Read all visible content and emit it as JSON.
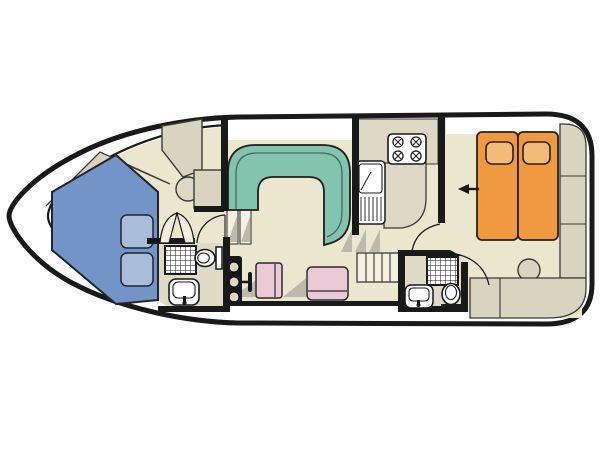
{
  "diagram": {
    "type": "boat-deck-plan",
    "orientation": {
      "bow": "left",
      "stern": "right"
    },
    "colors": {
      "hull": "#191919",
      "floor": "#ebe7cf",
      "bathroomFloor": "#dfdbc6",
      "cabinet": "#d8d4c0",
      "counter": "#dcd8c4",
      "sofa": "#82c4ae",
      "vberth": "#7394c7",
      "vberthPillow": "#a9bddb",
      "bedOrange": "#ef9940",
      "bedPillow": "#f4ba77",
      "seatPink": "#ecc9d7",
      "shadow": "#bdbaab",
      "fixture": "#ffffff",
      "steps": "#f4f1e0",
      "doorLeaf": "#f2eedd",
      "console": "#17181c"
    },
    "rooms": [
      {
        "id": "forward-cabin",
        "label": "forward-cabin-v-berth"
      },
      {
        "id": "forward-bathroom",
        "label": "forward-bathroom"
      },
      {
        "id": "saloon",
        "label": "saloon-with-u-sofa-and-helm"
      },
      {
        "id": "galley",
        "label": "galley"
      },
      {
        "id": "aft-bathroom",
        "label": "aft-bathroom"
      },
      {
        "id": "aft-cabin",
        "label": "aft-cabin-double-bed"
      }
    ],
    "furniture": [
      "v-berth-bed",
      "v-berth-pillows",
      "wardrobe",
      "cabinet",
      "wash-basin",
      "shower",
      "toilet",
      "sink",
      "helm-console",
      "throttle-lever",
      "helm-seat",
      "bench-seat",
      "u-sofa",
      "stove-4-burner",
      "galley-sink",
      "galley-counter",
      "companionway-stairs",
      "double-bed",
      "bed-pillows",
      "stern-bench-side",
      "stern-bench-rear",
      "stool"
    ],
    "annotations": [
      {
        "id": "entrance-arrow",
        "shape": "left-arrow",
        "color": "#191919"
      }
    ]
  }
}
